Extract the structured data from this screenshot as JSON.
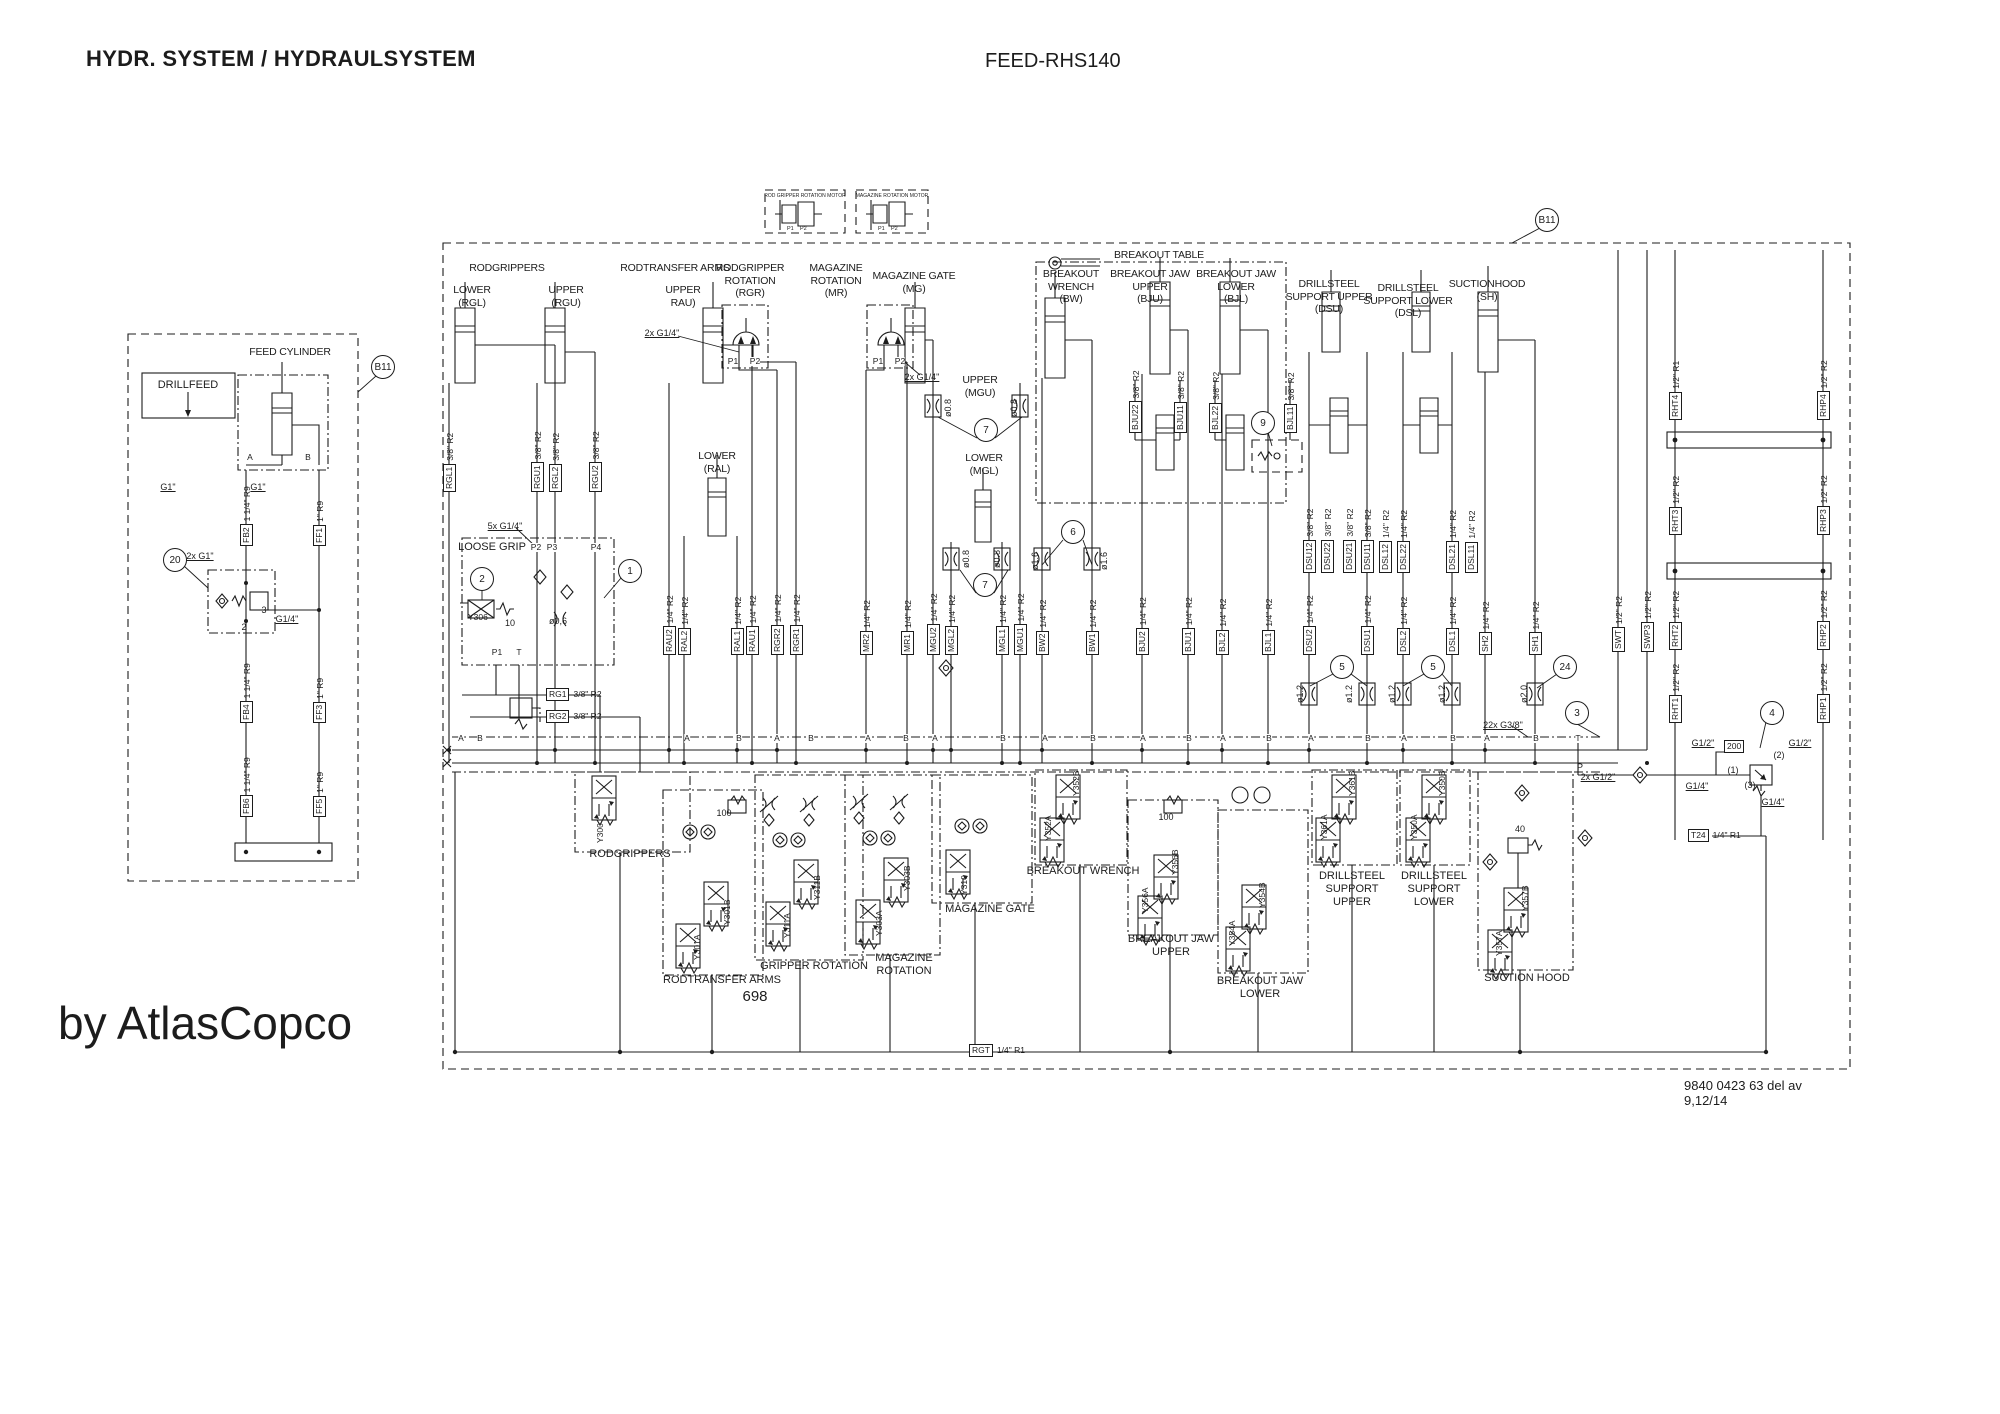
{
  "page": {
    "title_left": "HYDR. SYSTEM / HYDRAULSYSTEM",
    "title_right": "FEED-RHS140",
    "page_number": "698",
    "brand": "by AtlasCopco",
    "doc_number": "9840 0423 63 del av 9,12/14",
    "line_color": "#1c1c1c",
    "background": "#ffffff"
  },
  "component_titles": [
    {
      "t": "RODGRIPPERS",
      "x": 507,
      "y": 262
    },
    {
      "t": "LOWER\n(RGL)",
      "x": 472,
      "y": 284
    },
    {
      "t": "UPPER\n(RGU)",
      "x": 566,
      "y": 284
    },
    {
      "t": "RODTRANSFER ARMS",
      "x": 675,
      "y": 262
    },
    {
      "t": "UPPER\nRAU)",
      "x": 683,
      "y": 284
    },
    {
      "t": "RODGRIPPER\nROTATION\n(RGR)",
      "x": 750,
      "y": 262
    },
    {
      "t": "MAGAZINE\nROTATION\n(MR)",
      "x": 836,
      "y": 262
    },
    {
      "t": "MAGAZINE GATE\n(MG)",
      "x": 914,
      "y": 270
    },
    {
      "t": "BREAKOUT TABLE",
      "x": 1159,
      "y": 249
    },
    {
      "t": "BREAKOUT\nWRENCH\n(BW)",
      "x": 1071,
      "y": 268
    },
    {
      "t": "BREAKOUT JAW\nUPPER\n(BJU)",
      "x": 1150,
      "y": 268
    },
    {
      "t": "BREAKOUT JAW\nLOWER\n(BJL)",
      "x": 1236,
      "y": 268
    },
    {
      "t": "DRILLSTEEL\nSUPPORT UPPER\n(DSU)",
      "x": 1329,
      "y": 278
    },
    {
      "t": "DRILLSTEEL\nSUPPORT LOWER\n(DSL)",
      "x": 1408,
      "y": 282
    },
    {
      "t": "SUCTIONHOOD\n(SH)",
      "x": 1487,
      "y": 278
    },
    {
      "t": "UPPER\n(MGU)",
      "x": 980,
      "y": 374
    },
    {
      "t": "LOWER\n(MGL)",
      "x": 984,
      "y": 452
    },
    {
      "t": "LOWER\n(RAL)",
      "x": 717,
      "y": 450
    },
    {
      "t": "FEED CYLINDER",
      "x": 290,
      "y": 346
    },
    {
      "t": "ROD GRIPPER ROTATION MOTOR",
      "x": 805,
      "y": 193,
      "cls": "tiny"
    },
    {
      "t": "MAGAZINE ROTATION MOTOR",
      "x": 892,
      "y": 193,
      "cls": "tiny"
    }
  ],
  "section_labels": [
    {
      "t": "RODGRIPPERS",
      "x": 630,
      "y": 848
    },
    {
      "t": "RODTRANSFER ARMS",
      "x": 722,
      "y": 974
    },
    {
      "t": "GRIPPER ROTATION",
      "x": 814,
      "y": 960
    },
    {
      "t": "MAGAZINE\nROTATION",
      "x": 904,
      "y": 952
    },
    {
      "t": "MAGAZINE GATE",
      "x": 990,
      "y": 903
    },
    {
      "t": "BREAKOUT WRENCH",
      "x": 1083,
      "y": 865
    },
    {
      "t": "BREAKOUT JAW\nUPPER",
      "x": 1171,
      "y": 933
    },
    {
      "t": "BREAKOUT JAW\nLOWER",
      "x": 1260,
      "y": 975
    },
    {
      "t": "DRILLSTEEL\nSUPPORT\nUPPER",
      "x": 1352,
      "y": 870
    },
    {
      "t": "DRILLSTEEL\nSUPPORT\nLOWER",
      "x": 1434,
      "y": 870
    },
    {
      "t": "SUCTION HOOD",
      "x": 1527,
      "y": 972
    },
    {
      "t": "LOOSE GRIP",
      "x": 492,
      "y": 541
    },
    {
      "t": "DRILLFEED",
      "x": 188,
      "y": 379
    }
  ],
  "pipe_tags": [
    {
      "tag": "FB2",
      "size": "1 1/4\" R9",
      "x": 246,
      "y": 546
    },
    {
      "tag": "FF1",
      "size": "1\" R9",
      "x": 319,
      "y": 546
    },
    {
      "tag": "FB4",
      "size": "1 1/4\" R9",
      "x": 246,
      "y": 723
    },
    {
      "tag": "FF3",
      "size": "1\" R9",
      "x": 319,
      "y": 723
    },
    {
      "tag": "FB6",
      "size": "1 1/4\" R9",
      "x": 246,
      "y": 817
    },
    {
      "tag": "FF5",
      "size": "1\" R9",
      "x": 319,
      "y": 817
    },
    {
      "tag": "RGL1",
      "size": "3/8\" R2",
      "x": 449,
      "y": 492
    },
    {
      "tag": "RGU1",
      "size": "3/8\" R2",
      "x": 537,
      "y": 492
    },
    {
      "tag": "RGL2",
      "size": "3/8\" R2",
      "x": 555,
      "y": 492
    },
    {
      "tag": "RGU2",
      "size": "3/8\" R2",
      "x": 595,
      "y": 492
    },
    {
      "tag": "RAU2",
      "size": "1/4\" R2",
      "x": 669,
      "y": 655
    },
    {
      "tag": "RAL2",
      "size": "1/4\" R2",
      "x": 684,
      "y": 655
    },
    {
      "tag": "RAL1",
      "size": "1/4\" R2",
      "x": 737,
      "y": 655
    },
    {
      "tag": "RAU1",
      "size": "1/4\" R2",
      "x": 752,
      "y": 655
    },
    {
      "tag": "RGR2",
      "size": "1/4\" R2",
      "x": 777,
      "y": 655
    },
    {
      "tag": "RGR1",
      "size": "1/4\" R2",
      "x": 796,
      "y": 655
    },
    {
      "tag": "MR2",
      "size": "1/4\" R2",
      "x": 866,
      "y": 655
    },
    {
      "tag": "MR1",
      "size": "1/4\" R2",
      "x": 907,
      "y": 655
    },
    {
      "tag": "MGU2",
      "size": "1/4\" R2",
      "x": 933,
      "y": 655
    },
    {
      "tag": "MGL2",
      "size": "1/4\" R2",
      "x": 951,
      "y": 655
    },
    {
      "tag": "MGL1",
      "size": "1/4\" R2",
      "x": 1002,
      "y": 655
    },
    {
      "tag": "MGU1",
      "size": "1/4\" R2",
      "x": 1020,
      "y": 655
    },
    {
      "tag": "BW2",
      "size": "1/4\" R2",
      "x": 1042,
      "y": 655
    },
    {
      "tag": "BW1",
      "size": "1/4\" R2",
      "x": 1092,
      "y": 655
    },
    {
      "tag": "BJU2",
      "size": "1/4\" R2",
      "x": 1142,
      "y": 655
    },
    {
      "tag": "BJU1",
      "size": "1/4\" R2",
      "x": 1188,
      "y": 655
    },
    {
      "tag": "BJL2",
      "size": "1/4\" R2",
      "x": 1222,
      "y": 655
    },
    {
      "tag": "BJL1",
      "size": "1/4\" R2",
      "x": 1268,
      "y": 655
    },
    {
      "tag": "BJU22",
      "size": "3/8\" R2",
      "x": 1135,
      "y": 433
    },
    {
      "tag": "BJU11",
      "size": "3/8\" R2",
      "x": 1180,
      "y": 433
    },
    {
      "tag": "BJL22",
      "size": "3/8\" R2",
      "x": 1215,
      "y": 433
    },
    {
      "tag": "BJL11",
      "size": "3/8\" R2",
      "x": 1290,
      "y": 433
    },
    {
      "tag": "DSU12",
      "size": "3/8\" R2",
      "x": 1309,
      "y": 573
    },
    {
      "tag": "DSU22",
      "size": "3/8\" R2",
      "x": 1327,
      "y": 573
    },
    {
      "tag": "DSU21",
      "size": "3/8\" R2",
      "x": 1349,
      "y": 573
    },
    {
      "tag": "DSU11",
      "size": "3/8\" R2",
      "x": 1367,
      "y": 573
    },
    {
      "tag": "DSL12",
      "size": "1/4\" R2",
      "x": 1385,
      "y": 573
    },
    {
      "tag": "DSL22",
      "size": "1/4\" R2",
      "x": 1403,
      "y": 573
    },
    {
      "tag": "DSL21",
      "size": "1/4\" R2",
      "x": 1452,
      "y": 573
    },
    {
      "tag": "DSL11",
      "size": "1/4\" R2",
      "x": 1471,
      "y": 573
    },
    {
      "tag": "DSU2",
      "size": "1/4\" R2",
      "x": 1309,
      "y": 655
    },
    {
      "tag": "DSU1",
      "size": "1/4\" R2",
      "x": 1367,
      "y": 655
    },
    {
      "tag": "DSL2",
      "size": "1/4\" R2",
      "x": 1403,
      "y": 655
    },
    {
      "tag": "DSL1",
      "size": "1/4\" R2",
      "x": 1452,
      "y": 655
    },
    {
      "tag": "SH2",
      "size": "1/4\" R2",
      "x": 1485,
      "y": 655
    },
    {
      "tag": "SH1",
      "size": "1/4\" R2",
      "x": 1535,
      "y": 655
    },
    {
      "tag": "SWT",
      "size": "1/2\" R2",
      "x": 1618,
      "y": 652
    },
    {
      "tag": "SWP3",
      "size": "1/2\" R2",
      "x": 1647,
      "y": 652
    },
    {
      "tag": "RHT4",
      "size": "1/2\" R1",
      "x": 1675,
      "y": 420
    },
    {
      "tag": "RHT3",
      "size": "1/2\" R2",
      "x": 1675,
      "y": 535
    },
    {
      "tag": "RHT2",
      "size": "1/2\" R2",
      "x": 1675,
      "y": 650
    },
    {
      "tag": "RHT1",
      "size": "1/2\" R2",
      "x": 1675,
      "y": 723
    },
    {
      "tag": "RHP4",
      "size": "1/2\" R2",
      "x": 1823,
      "y": 420
    },
    {
      "tag": "RHP3",
      "size": "1/2\" R2",
      "x": 1823,
      "y": 535
    },
    {
      "tag": "RHP2",
      "size": "1/2\" R2",
      "x": 1823,
      "y": 650
    },
    {
      "tag": "RHP1",
      "size": "1/2\" R2",
      "x": 1823,
      "y": 723
    }
  ],
  "htags": [
    {
      "tag": "RG1",
      "size": "3/8\" R2",
      "x": 546,
      "y": 688
    },
    {
      "tag": "RG2",
      "size": "3/8\" R2",
      "x": 546,
      "y": 710
    },
    {
      "tag": "RGT",
      "size": "1/4\" R1",
      "x": 969,
      "y": 1044
    },
    {
      "tag": "T24",
      "size": "1/4\" R1",
      "x": 1688,
      "y": 829
    },
    {
      "tag": "200",
      "size": "",
      "x": 1724,
      "y": 740
    }
  ],
  "callouts": [
    {
      "n": "20",
      "x": 175,
      "y": 560
    },
    {
      "n": "2",
      "x": 482,
      "y": 579
    },
    {
      "n": "1",
      "x": 630,
      "y": 571
    },
    {
      "n": "7",
      "x": 986,
      "y": 430
    },
    {
      "n": "7",
      "x": 985,
      "y": 585
    },
    {
      "n": "6",
      "x": 1073,
      "y": 532
    },
    {
      "n": "9",
      "x": 1263,
      "y": 423
    },
    {
      "n": "5",
      "x": 1342,
      "y": 667
    },
    {
      "n": "5",
      "x": 1433,
      "y": 667
    },
    {
      "n": "24",
      "x": 1565,
      "y": 667
    },
    {
      "n": "3",
      "x": 1577,
      "y": 713
    },
    {
      "n": "4",
      "x": 1772,
      "y": 713
    },
    {
      "n": "B11",
      "x": 383,
      "y": 367
    },
    {
      "n": "B11",
      "x": 1547,
      "y": 220
    }
  ],
  "valve_ids": [
    {
      "id": "Y306",
      "x": 468,
      "y": 612,
      "cls": "h"
    },
    {
      "id": "Y300",
      "x": 600,
      "y": 843
    },
    {
      "id": "Y301B",
      "x": 727,
      "y": 925
    },
    {
      "id": "Y301A",
      "x": 697,
      "y": 960
    },
    {
      "id": "Y311B",
      "x": 817,
      "y": 900
    },
    {
      "id": "Y311A",
      "x": 787,
      "y": 938
    },
    {
      "id": "Y303B",
      "x": 907,
      "y": 891
    },
    {
      "id": "Y303A",
      "x": 879,
      "y": 936
    },
    {
      "id": "Y310",
      "x": 964,
      "y": 895
    },
    {
      "id": "Y352B",
      "x": 1076,
      "y": 796
    },
    {
      "id": "Y352A",
      "x": 1048,
      "y": 841
    },
    {
      "id": "Y356B",
      "x": 1175,
      "y": 875
    },
    {
      "id": "Y356A",
      "x": 1145,
      "y": 913
    },
    {
      "id": "Y354B",
      "x": 1262,
      "y": 908
    },
    {
      "id": "Y354A",
      "x": 1232,
      "y": 946
    },
    {
      "id": "Y361B",
      "x": 1352,
      "y": 796
    },
    {
      "id": "Y361A",
      "x": 1324,
      "y": 840
    },
    {
      "id": "Y350B",
      "x": 1442,
      "y": 796
    },
    {
      "id": "Y350A",
      "x": 1414,
      "y": 840
    },
    {
      "id": "Y357B",
      "x": 1525,
      "y": 911
    },
    {
      "id": "Y357A",
      "x": 1499,
      "y": 956
    }
  ],
  "annotations": [
    {
      "t": "5x G1/4\"",
      "x": 505,
      "y": 521,
      "u": 1
    },
    {
      "t": "2x G1/4\"",
      "x": 662,
      "y": 328,
      "u": 1
    },
    {
      "t": "2x G1/4\"",
      "x": 922,
      "y": 372,
      "u": 1
    },
    {
      "t": "2x G1\"",
      "x": 200,
      "y": 551,
      "u": 1
    },
    {
      "t": "G1\"",
      "x": 168,
      "y": 482,
      "u": 1
    },
    {
      "t": "G1\"",
      "x": 258,
      "y": 482,
      "u": 1
    },
    {
      "t": "G1/4\"",
      "x": 287,
      "y": 614,
      "u": 1
    },
    {
      "t": "22x G3/8\"",
      "x": 1503,
      "y": 720,
      "u": 1
    },
    {
      "t": "2x G1/2\"",
      "x": 1598,
      "y": 772,
      "u": 1
    },
    {
      "t": "G1/2\"",
      "x": 1703,
      "y": 738,
      "u": 1
    },
    {
      "t": "G1/2\"",
      "x": 1800,
      "y": 738,
      "u": 1
    },
    {
      "t": "G1/4\"",
      "x": 1697,
      "y": 781,
      "u": 1
    },
    {
      "t": "G1/4\"",
      "x": 1773,
      "y": 797,
      "u": 1
    },
    {
      "t": "(1)",
      "x": 1733,
      "y": 765
    },
    {
      "t": "(2)",
      "x": 1779,
      "y": 750
    },
    {
      "t": "(3)",
      "x": 1750,
      "y": 780
    },
    {
      "t": "P",
      "x": 1580,
      "y": 762
    },
    {
      "t": "ø0,6",
      "x": 558,
      "y": 616
    },
    {
      "t": "10",
      "x": 510,
      "y": 618
    },
    {
      "t": "100",
      "x": 724,
      "y": 808
    },
    {
      "t": "100",
      "x": 1166,
      "y": 812
    },
    {
      "t": "40",
      "x": 1520,
      "y": 824
    },
    {
      "t": "2",
      "x": 244,
      "y": 622
    },
    {
      "t": "3",
      "x": 264,
      "y": 605
    },
    {
      "t": "ø0.8",
      "x": 948,
      "y": 417,
      "rot": 1
    },
    {
      "t": "ø0.8",
      "x": 1014,
      "y": 417,
      "rot": 1
    },
    {
      "t": "ø0.8",
      "x": 966,
      "y": 568,
      "rot": 1
    },
    {
      "t": "ø0.8",
      "x": 997,
      "y": 568,
      "rot": 1
    },
    {
      "t": "ø1.6",
      "x": 1035,
      "y": 570,
      "rot": 1
    },
    {
      "t": "ø1.6",
      "x": 1104,
      "y": 570,
      "rot": 1
    },
    {
      "t": "ø1.2",
      "x": 1300,
      "y": 703,
      "rot": 1
    },
    {
      "t": "ø1.2",
      "x": 1349,
      "y": 703,
      "rot": 1
    },
    {
      "t": "ø1.2",
      "x": 1392,
      "y": 703,
      "rot": 1
    },
    {
      "t": "ø1.2",
      "x": 1442,
      "y": 703,
      "rot": 1
    },
    {
      "t": "ø2.0",
      "x": 1524,
      "y": 703,
      "rot": 1
    },
    {
      "t": "P1",
      "x": 787,
      "y": 226,
      "cls": "t6"
    },
    {
      "t": "P2",
      "x": 800,
      "y": 226,
      "cls": "t6"
    },
    {
      "t": "P1",
      "x": 878,
      "y": 226,
      "cls": "t6"
    },
    {
      "t": "P2",
      "x": 891,
      "y": 226,
      "cls": "t6"
    }
  ],
  "port_letters": [
    {
      "t": "A",
      "x": 461,
      "y": 734
    },
    {
      "t": "B",
      "x": 480,
      "y": 734
    },
    {
      "t": "A",
      "x": 687,
      "y": 734
    },
    {
      "t": "B",
      "x": 739,
      "y": 734
    },
    {
      "t": "A",
      "x": 777,
      "y": 734
    },
    {
      "t": "B",
      "x": 811,
      "y": 734
    },
    {
      "t": "A",
      "x": 868,
      "y": 734
    },
    {
      "t": "B",
      "x": 906,
      "y": 734
    },
    {
      "t": "A",
      "x": 935,
      "y": 734
    },
    {
      "t": "B",
      "x": 1003,
      "y": 734
    },
    {
      "t": "A",
      "x": 1045,
      "y": 734
    },
    {
      "t": "B",
      "x": 1093,
      "y": 734
    },
    {
      "t": "A",
      "x": 1143,
      "y": 734
    },
    {
      "t": "B",
      "x": 1189,
      "y": 734
    },
    {
      "t": "A",
      "x": 1223,
      "y": 734
    },
    {
      "t": "B",
      "x": 1269,
      "y": 734
    },
    {
      "t": "A",
      "x": 1311,
      "y": 734
    },
    {
      "t": "B",
      "x": 1368,
      "y": 734
    },
    {
      "t": "A",
      "x": 1404,
      "y": 734
    },
    {
      "t": "B",
      "x": 1453,
      "y": 734
    },
    {
      "t": "A",
      "x": 1487,
      "y": 734
    },
    {
      "t": "B",
      "x": 1536,
      "y": 734
    },
    {
      "t": "T",
      "x": 1578,
      "y": 734
    },
    {
      "t": "P2",
      "x": 536,
      "y": 543
    },
    {
      "t": "P3",
      "x": 552,
      "y": 543
    },
    {
      "t": "P4",
      "x": 596,
      "y": 543
    },
    {
      "t": "P1",
      "x": 497,
      "y": 648
    },
    {
      "t": "T",
      "x": 519,
      "y": 648
    },
    {
      "t": "P1",
      "x": 733,
      "y": 357
    },
    {
      "t": "P2",
      "x": 755,
      "y": 357
    },
    {
      "t": "P1",
      "x": 878,
      "y": 357
    },
    {
      "t": "P2",
      "x": 900,
      "y": 357
    },
    {
      "t": "A",
      "x": 250,
      "y": 453
    },
    {
      "t": "B",
      "x": 308,
      "y": 453
    }
  ]
}
